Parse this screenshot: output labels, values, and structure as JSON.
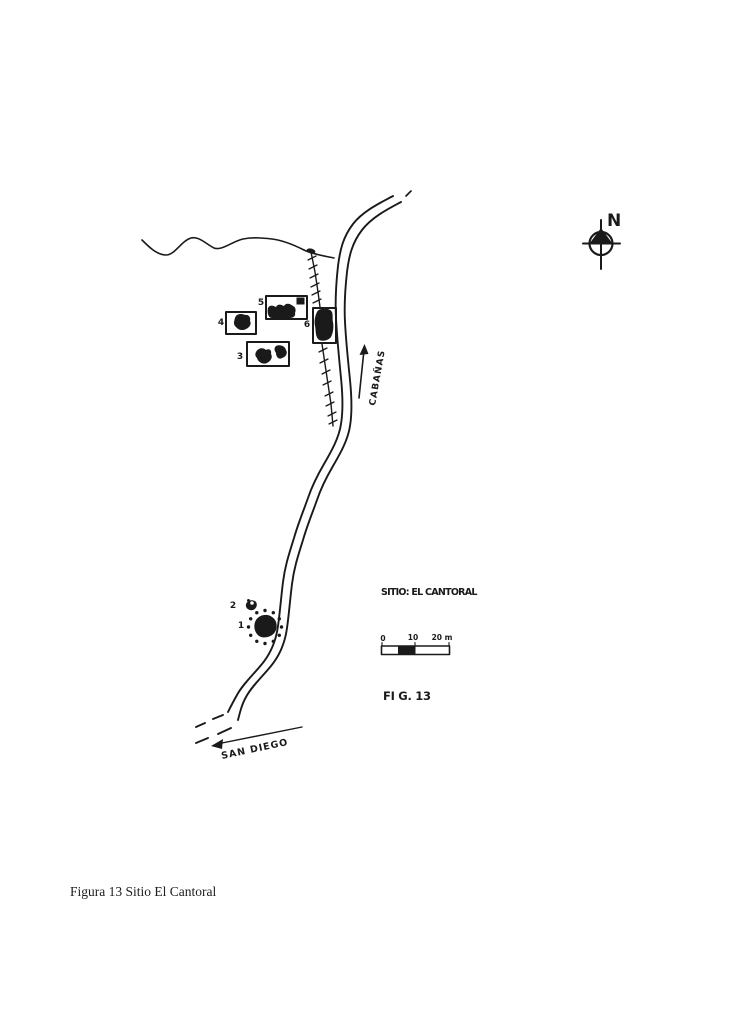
{
  "figure": {
    "caption": "Figura 13 Sitio El Cantoral",
    "site_label": "SITIO: EL CANTORAL",
    "figure_label": "FI G. 13",
    "north_label": "N",
    "roads": {
      "cabanas": "CABAÑAS",
      "san_diego": "SAN DIEGO"
    },
    "scale_bar": {
      "tick_0": "0",
      "tick_10": "10",
      "tick_20": "20 m"
    },
    "structures": [
      {
        "label": "1"
      },
      {
        "label": "2"
      },
      {
        "label": "3"
      },
      {
        "label": "4"
      },
      {
        "label": "5"
      },
      {
        "label": "6"
      }
    ],
    "colors": {
      "ink": "#1a1a1a",
      "paper": "#ffffff"
    }
  }
}
